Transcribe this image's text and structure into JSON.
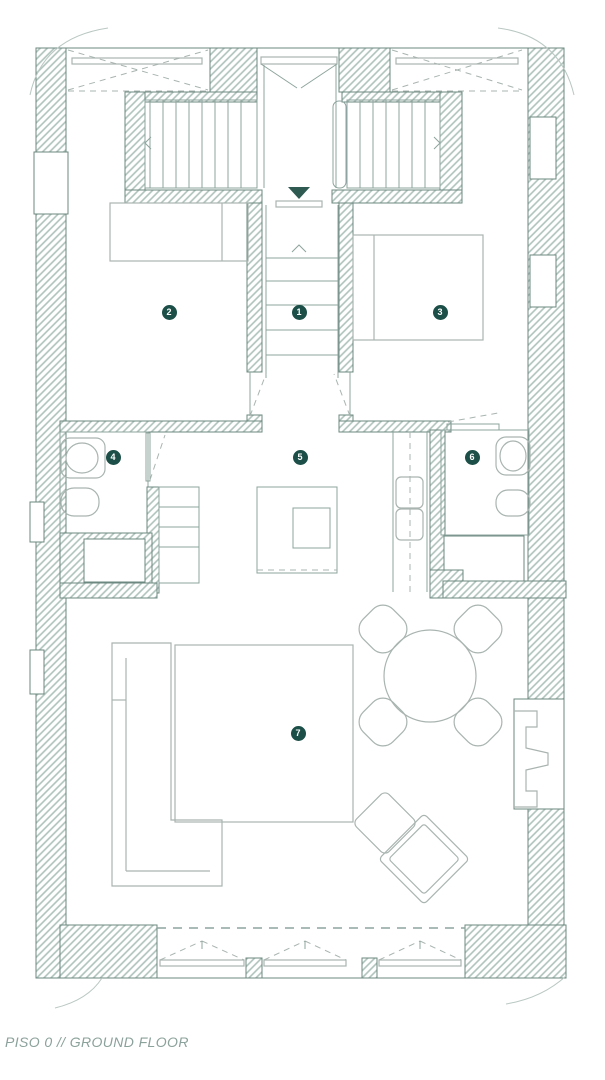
{
  "caption": "PISO 0 // GROUND FLOOR",
  "markers": [
    {
      "label": "1"
    },
    {
      "label": "2"
    },
    {
      "label": "3"
    },
    {
      "label": "4"
    },
    {
      "label": "5"
    },
    {
      "label": "6"
    },
    {
      "label": "7"
    }
  ],
  "colors": {
    "marker_bg": "#1b4f47",
    "marker_text": "#ffffff",
    "wall_outline": "#6d8881",
    "wall_hatch": "#aec1bb",
    "furniture_line": "#a9b4b0",
    "step_line": "#8ea49e",
    "caption": "#8ba19b",
    "accent_dark": "#2e5a52",
    "background": "#ffffff"
  }
}
